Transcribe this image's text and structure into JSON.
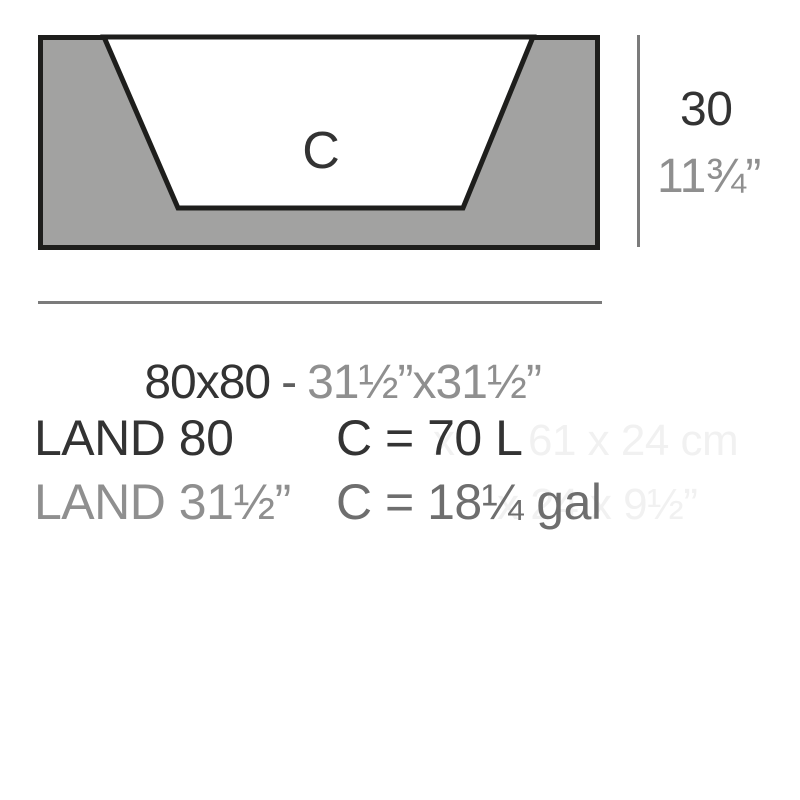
{
  "colors": {
    "fill_gray": "#a2a2a1",
    "outline_dark": "#1e1e1c",
    "dim_line_gray": "#7b7b7b",
    "text_dark": "#333333",
    "text_gray": "#8f8f8f",
    "text_gray_dark": "#6e6e6e",
    "ghost": "#f1f1f1"
  },
  "diagram": {
    "cavity_label": "C"
  },
  "dimensions": {
    "height": {
      "cm": "30",
      "inches": "11¾”"
    },
    "width": {
      "cm": "80x80",
      "separator": "-",
      "inches": "31½”x31½”"
    }
  },
  "product": {
    "model_cm": "LAND 80",
    "model_inches": "LAND 31½”",
    "capacity_liters": "C = 70 L",
    "capacity_gallons": "C = 18¼ gal"
  },
  "ghost_text": {
    "line1_fragment_a": "x",
    "line1_fragment_b": "61 x 24 cm",
    "line2_fragment": "x 24 x 9½”"
  }
}
